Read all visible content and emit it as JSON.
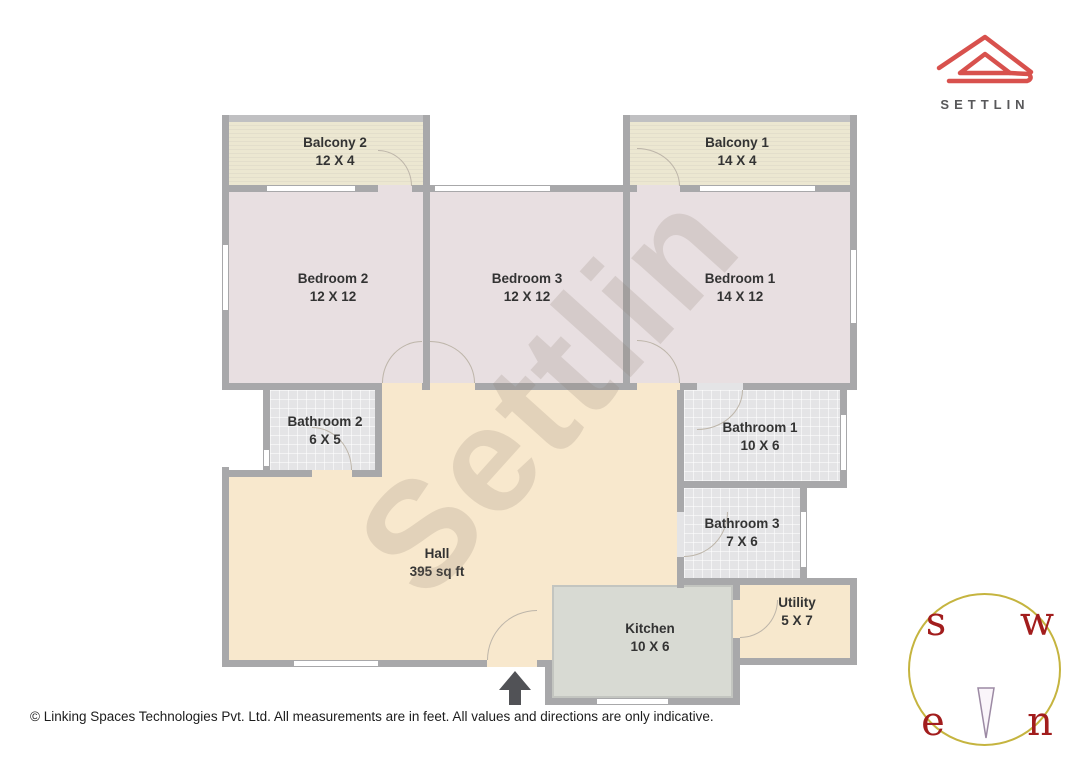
{
  "logo": {
    "brand": "SETTLIN"
  },
  "watermark": "Settlin",
  "rooms": [
    {
      "id": "balcony2",
      "name": "Balcony 2",
      "dims": "12 X 4"
    },
    {
      "id": "balcony1",
      "name": "Balcony 1",
      "dims": "14 X 4"
    },
    {
      "id": "bedroom2",
      "name": "Bedroom 2",
      "dims": "12 X 12"
    },
    {
      "id": "bedroom3",
      "name": "Bedroom 3",
      "dims": "12 X 12"
    },
    {
      "id": "bedroom1",
      "name": "Bedroom 1",
      "dims": "14 X 12"
    },
    {
      "id": "bathroom2",
      "name": "Bathroom 2",
      "dims": "6 X 5"
    },
    {
      "id": "bathroom1",
      "name": "Bathroom 1",
      "dims": "10 X 6"
    },
    {
      "id": "bathroom3",
      "name": "Bathroom 3",
      "dims": "7 X 6"
    },
    {
      "id": "hall",
      "name": "Hall",
      "dims": "395 sq ft"
    },
    {
      "id": "kitchen",
      "name": "Kitchen",
      "dims": "10 X 6"
    },
    {
      "id": "utility",
      "name": "Utility",
      "dims": "5 X 7"
    }
  ],
  "compass": {
    "s": "s",
    "w": "w",
    "e": "e",
    "n": "n"
  },
  "footer": {
    "copyright": "© Linking Spaces Technologies Pvt. Ltd. All measurements are in feet. All values and directions are only indicative."
  },
  "colors": {
    "logo_red": "#d8514d",
    "compass_letter_red": "#a21d1d",
    "compass_circle_olive": "#c5b43f",
    "needle_purple": "#9c8aa4",
    "wall_gray": "#a8a8aa",
    "bedroom_fill": "#e8dfe1",
    "balcony_fill": "#ece7d1",
    "hall_fill": "#f8e8cd",
    "bathroom_fill": "#e4e4e6",
    "kitchen_fill": "#d8dad3",
    "arrow_gray": "#515256"
  }
}
